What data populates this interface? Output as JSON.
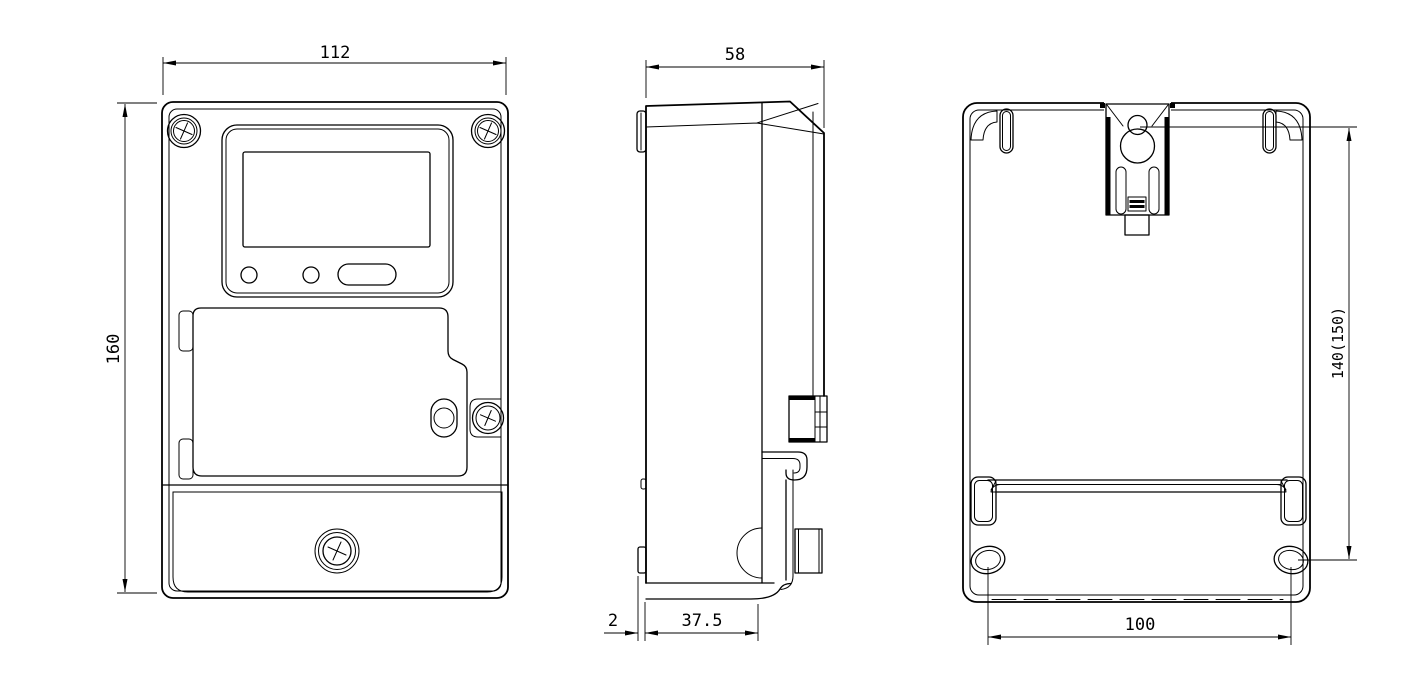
{
  "drawing": {
    "description": "three-view outline drawing of a single-phase electronic energy meter (front, side, back)",
    "background_color": "#ffffff",
    "line_color": "#000000",
    "dimensions": {
      "front_width": "112",
      "front_height": "160",
      "side_depth": "58",
      "rear_tab_offset": "2",
      "terminal_cover_depth": "37.5",
      "hanger_to_hole": "140(150)",
      "mounting_hole_spacing": "100"
    }
  }
}
